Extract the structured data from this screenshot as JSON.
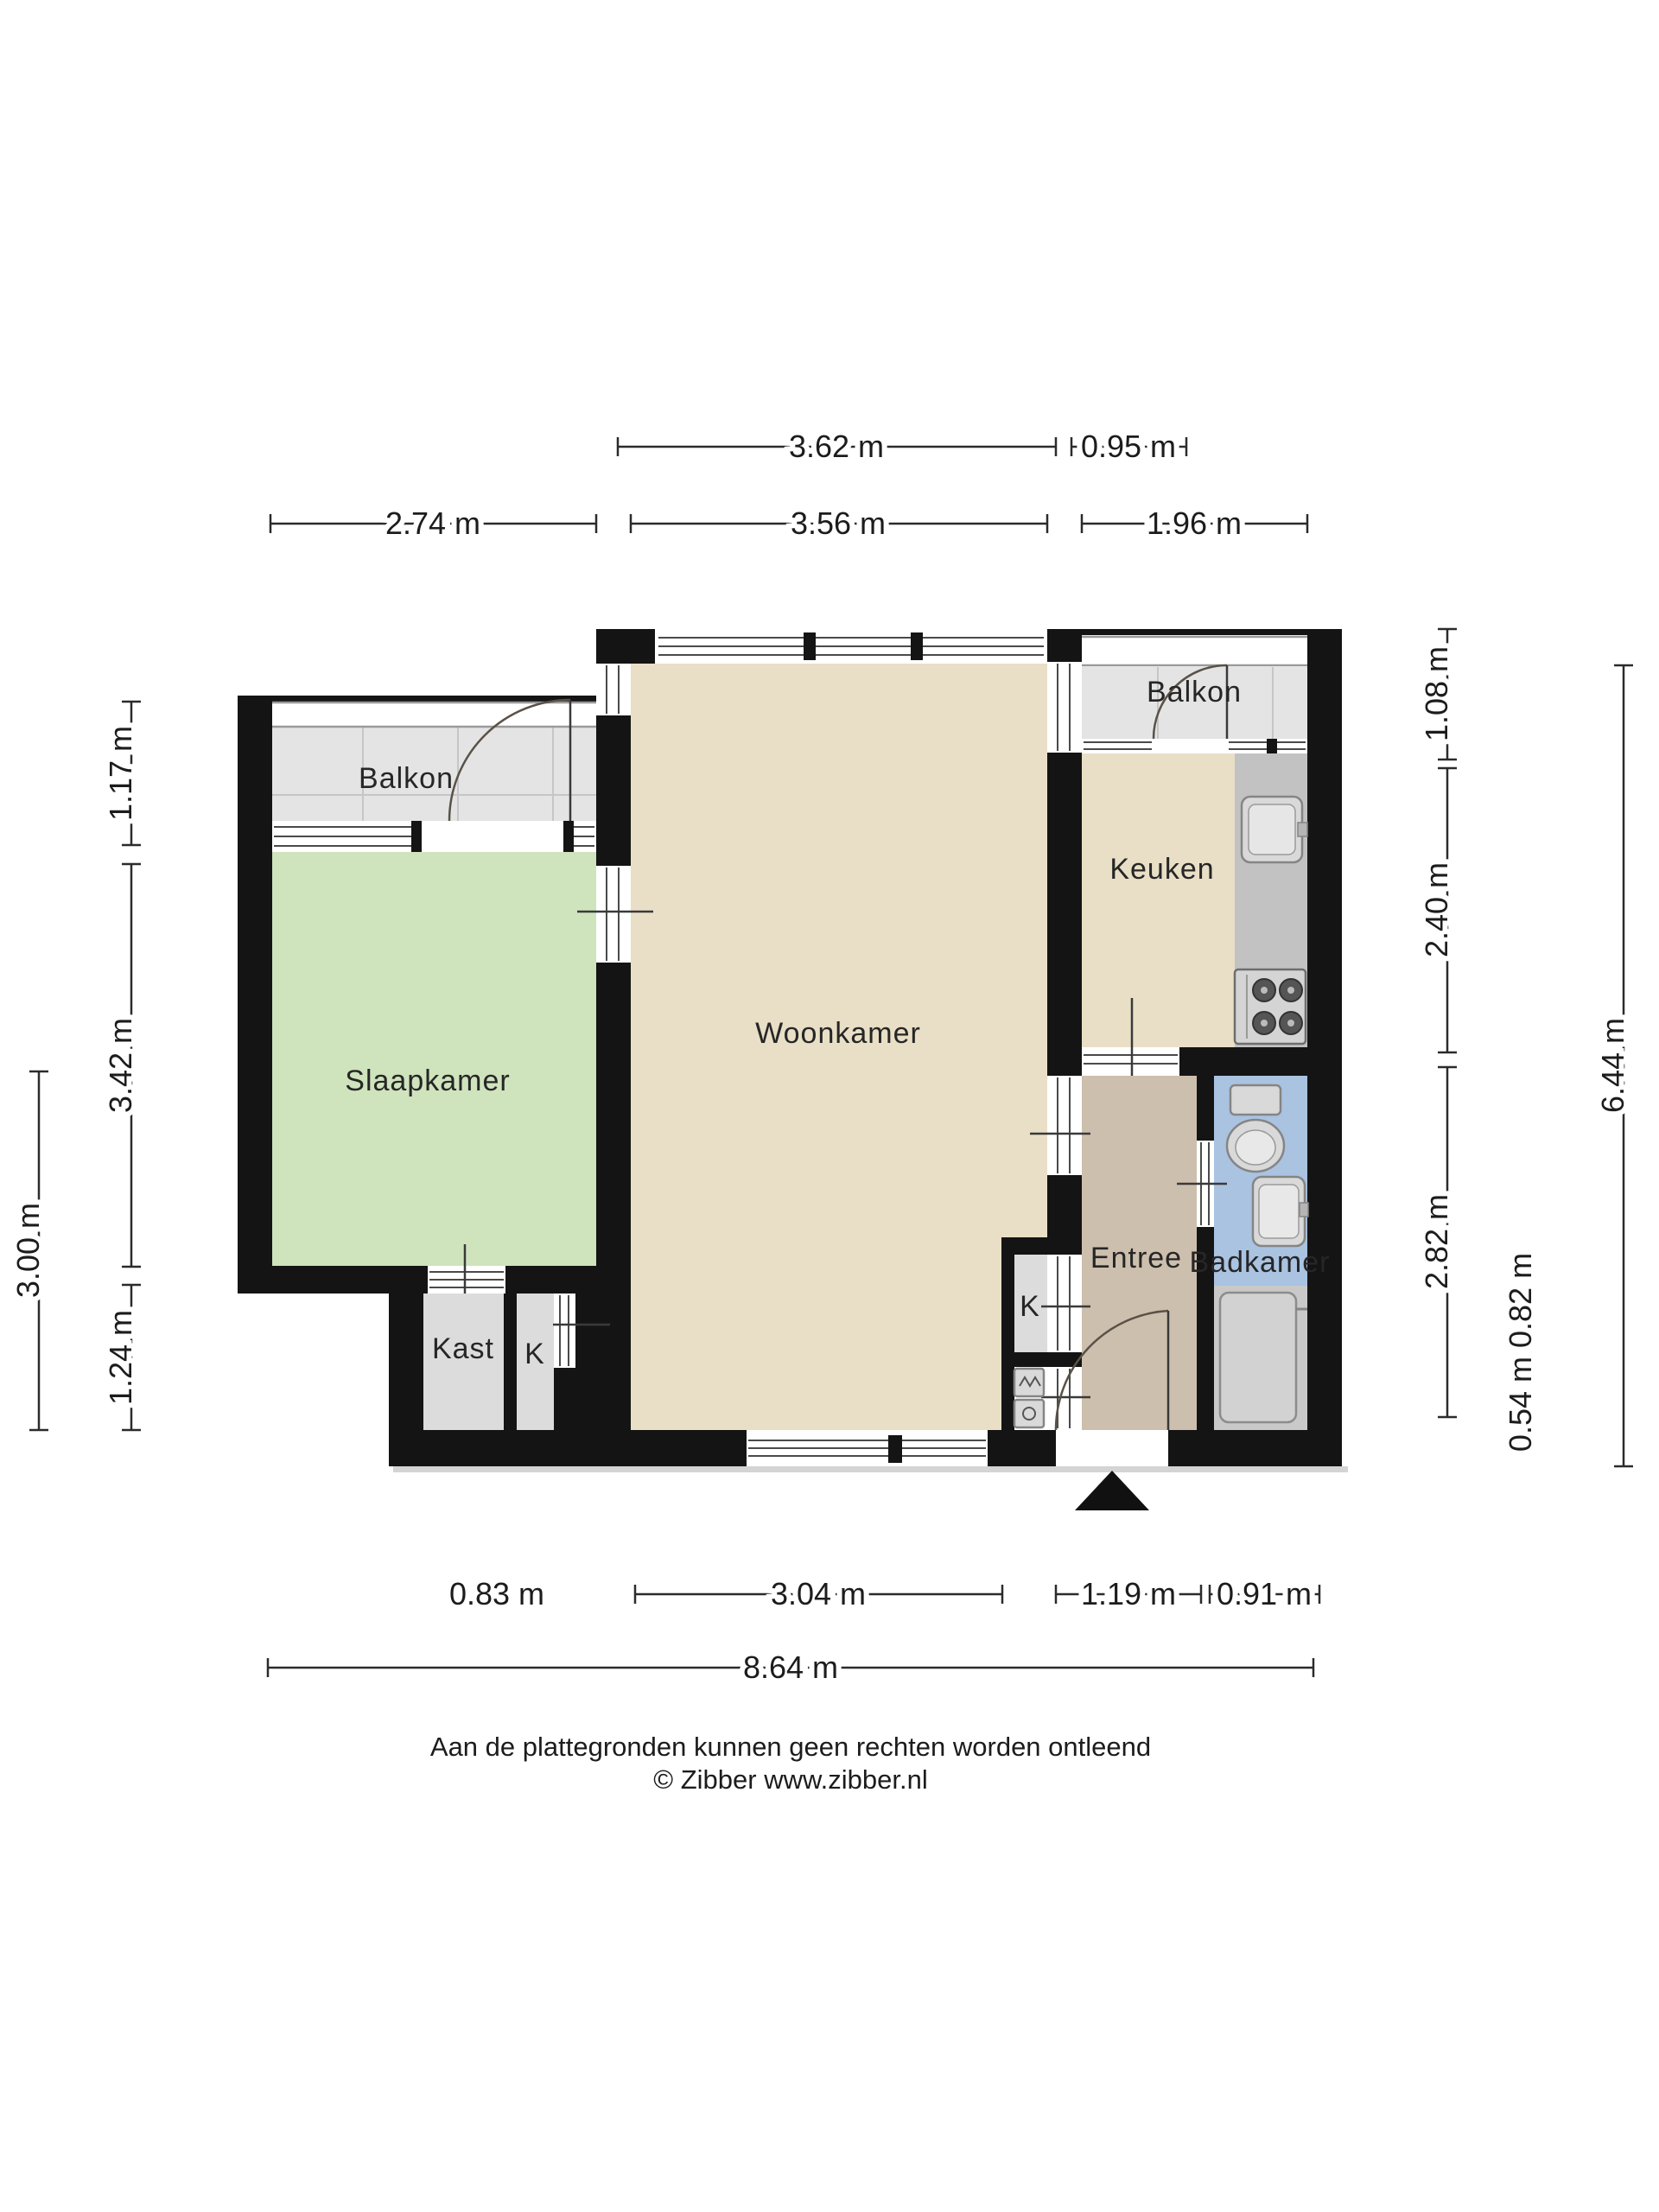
{
  "document": {
    "type": "floor-plan",
    "language": "nl"
  },
  "rooms": {
    "balcony_left": {
      "label": "Balkon"
    },
    "bedroom": {
      "label": "Slaapkamer"
    },
    "living": {
      "label": "Woonkamer"
    },
    "balcony_right": {
      "label": "Balkon"
    },
    "kitchen": {
      "label": "Keuken"
    },
    "entry": {
      "label": "Entree"
    },
    "bathroom": {
      "label": "Badkamer"
    },
    "closet": {
      "label": "Kast"
    },
    "closet_k1": {
      "label": "K"
    },
    "closet_k2": {
      "label": "K"
    }
  },
  "dimensions": {
    "top_row1": [
      "3.62 m",
      "0.95 m"
    ],
    "top_row2": [
      "2.74 m",
      "3.56 m",
      "1.96 m"
    ],
    "left_outer": "3.00 m",
    "left_inner": [
      "1.17 m",
      "3.42 m",
      "1.24 m"
    ],
    "right_inner": [
      "1.08 m",
      "2.40 m",
      "2.82 m"
    ],
    "right_small": "0.54 m 0.82 m",
    "right_outer": "6.44 m",
    "bottom": [
      "0.83 m",
      "3.04 m",
      "1.19 m",
      "0.91 m"
    ],
    "bottom_total": "8.64 m"
  },
  "footer": {
    "disclaimer": "Aan de plattegronden kunnen geen rechten worden ontleend",
    "copyright": "© Zibber www.zibber.nl"
  },
  "icons": {
    "entrance_arrow": "triangle-up"
  },
  "colors": {
    "wall": "#141414",
    "living": "#e9dfc6",
    "bedroom": "#cfe3bd",
    "entry": "#cdbfad",
    "bathroom": "#a9c3e1",
    "balcony": "#e4e4e4",
    "closet": "#dcdcdc",
    "counter": "#c2c2c2",
    "shower": "#c9c9c9",
    "fixture": "#d9d9d9"
  }
}
